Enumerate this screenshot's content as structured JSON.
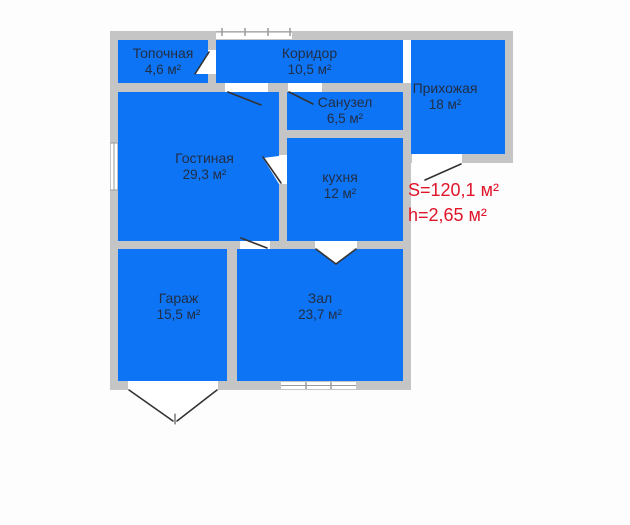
{
  "rooms": [
    {
      "id": "topochnaya",
      "name": "Топочная",
      "area": "4,6 м²"
    },
    {
      "id": "koridor",
      "name": "Коридор",
      "area": "10,5 м²"
    },
    {
      "id": "prihozhaya",
      "name": "Прихожая",
      "area": "18 м²"
    },
    {
      "id": "sanuzel",
      "name": "Санузел",
      "area": "6,5 м²"
    },
    {
      "id": "gostinaya",
      "name": "Гостиная",
      "area": "29,3 м²"
    },
    {
      "id": "kuhnya",
      "name": "кухня",
      "area": "12 м²"
    },
    {
      "id": "garazh",
      "name": "Гараж",
      "area": "15,5 м²"
    },
    {
      "id": "zal",
      "name": "Зал",
      "area": "23,7 м²"
    }
  ],
  "summary": {
    "total_area": "S=120,1 м²",
    "ceiling_height": "h=2,65 м²"
  },
  "colors": {
    "room_fill": "#0e74f6",
    "wall": "#c5c5c5",
    "annotation_red": "#e0152a",
    "room_text": "#212e44"
  }
}
